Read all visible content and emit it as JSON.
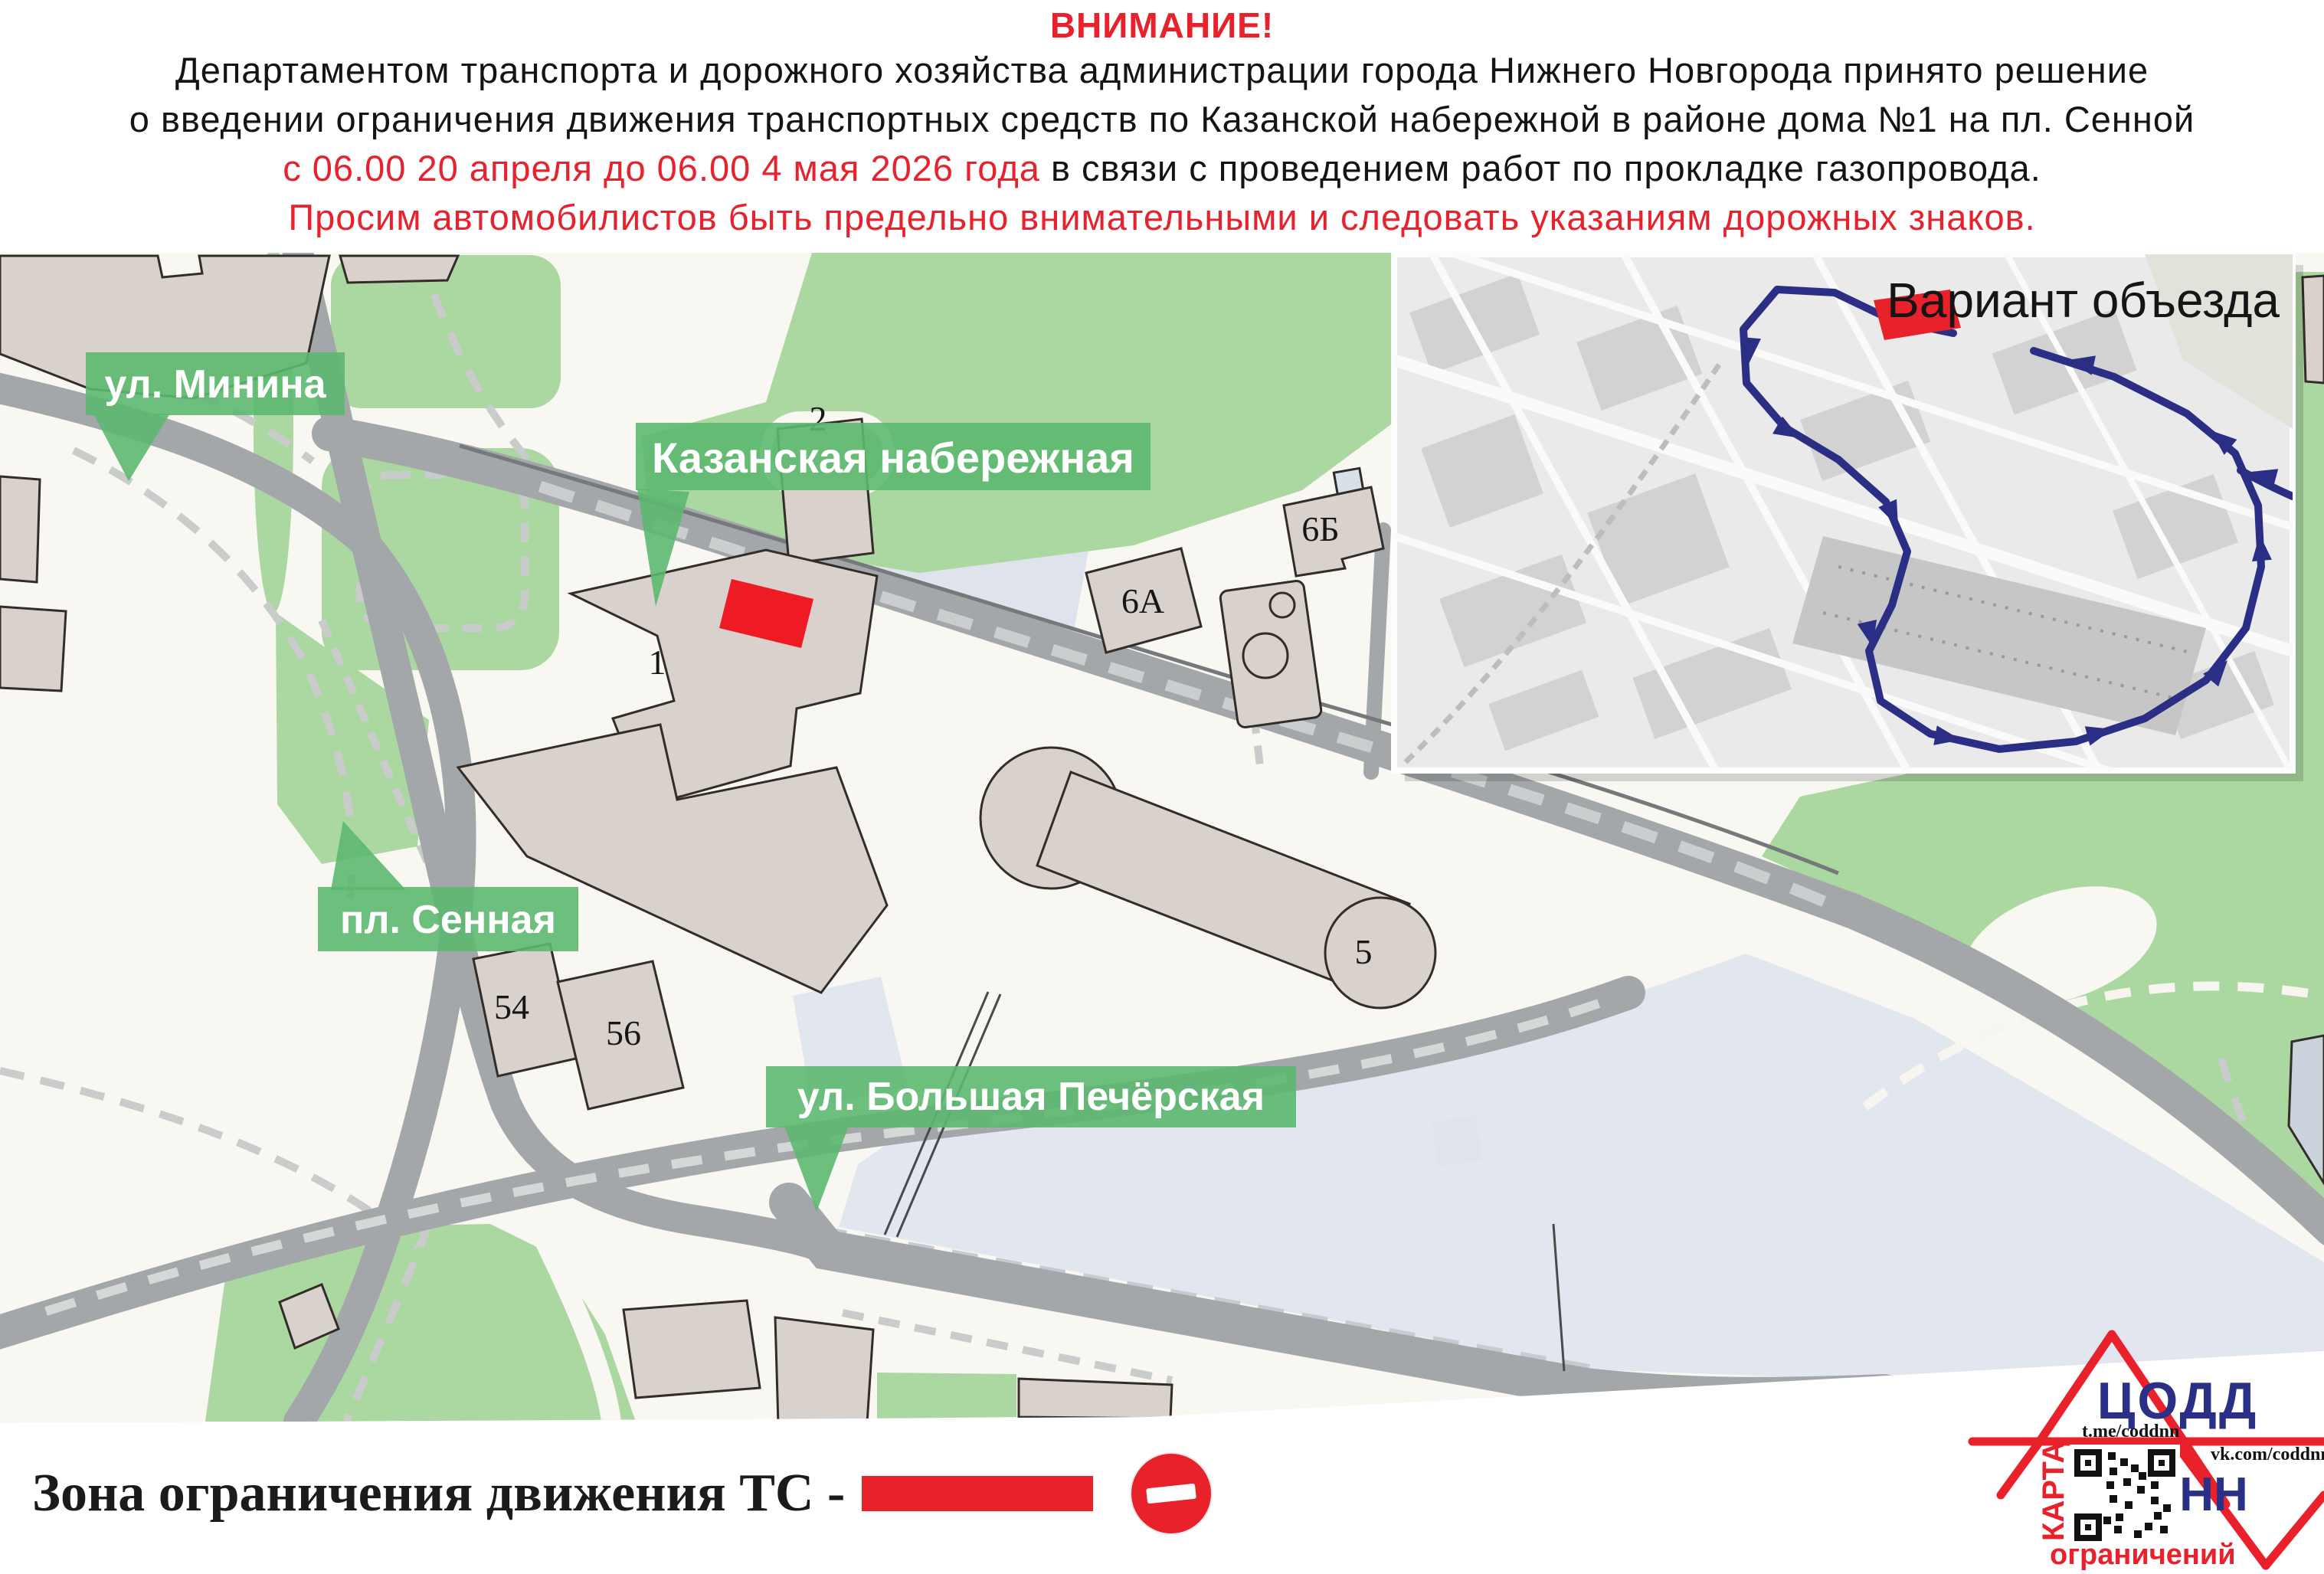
{
  "notice": {
    "title": "ВНИМАНИЕ!",
    "line1": "Департаментом транспорта и дорожного хозяйства администрации города Нижнего Новгорода принято решение",
    "line2": "о введении ограничения движения транспортных средств по Казанской набережной в районе дома №1 на пл. Сенной",
    "line3_red": "с 06.00 20 апреля до 06.00 4 мая 2026 года",
    "line3_black": " в связи с проведением работ по прокладке газопровода.",
    "line4": "Просим автомобилистов быть предельно внимательными и следовать указаниям дорожных знаков."
  },
  "map": {
    "labels": {
      "minina": "ул. Минина",
      "kazanskaya": "Казанская набережная",
      "sennaya": "пл. Сенная",
      "bolshaya": "ул. Большая Печёрская"
    },
    "buildings": {
      "b1": "1",
      "b2": "2",
      "b6a": "6А",
      "b6b": "6Б",
      "b5": "5",
      "b54": "54",
      "b56": "56"
    },
    "inset": {
      "title": "Вариант объезда"
    }
  },
  "legend": {
    "text": "Зона ограничения движения ТС -"
  },
  "logo": {
    "org": "ЦОДД",
    "nn": "НН",
    "telegram": "t.me/coddnn",
    "vk": "vk.com/coddnn52",
    "map_word": "КАРТА",
    "restrictions_word": "ограничений"
  },
  "colors": {
    "attention_red": "#E8222D",
    "marker_red": "#EE1B24",
    "label_green": "#5CB86F",
    "map_green": "#ABD7A0",
    "road_gray": "#A4A7A9",
    "pale_blue": "#DEE3EC",
    "route_navy": "#2B2E85",
    "logo_navy": "#2B3087",
    "logo_red": "#E8212A"
  }
}
